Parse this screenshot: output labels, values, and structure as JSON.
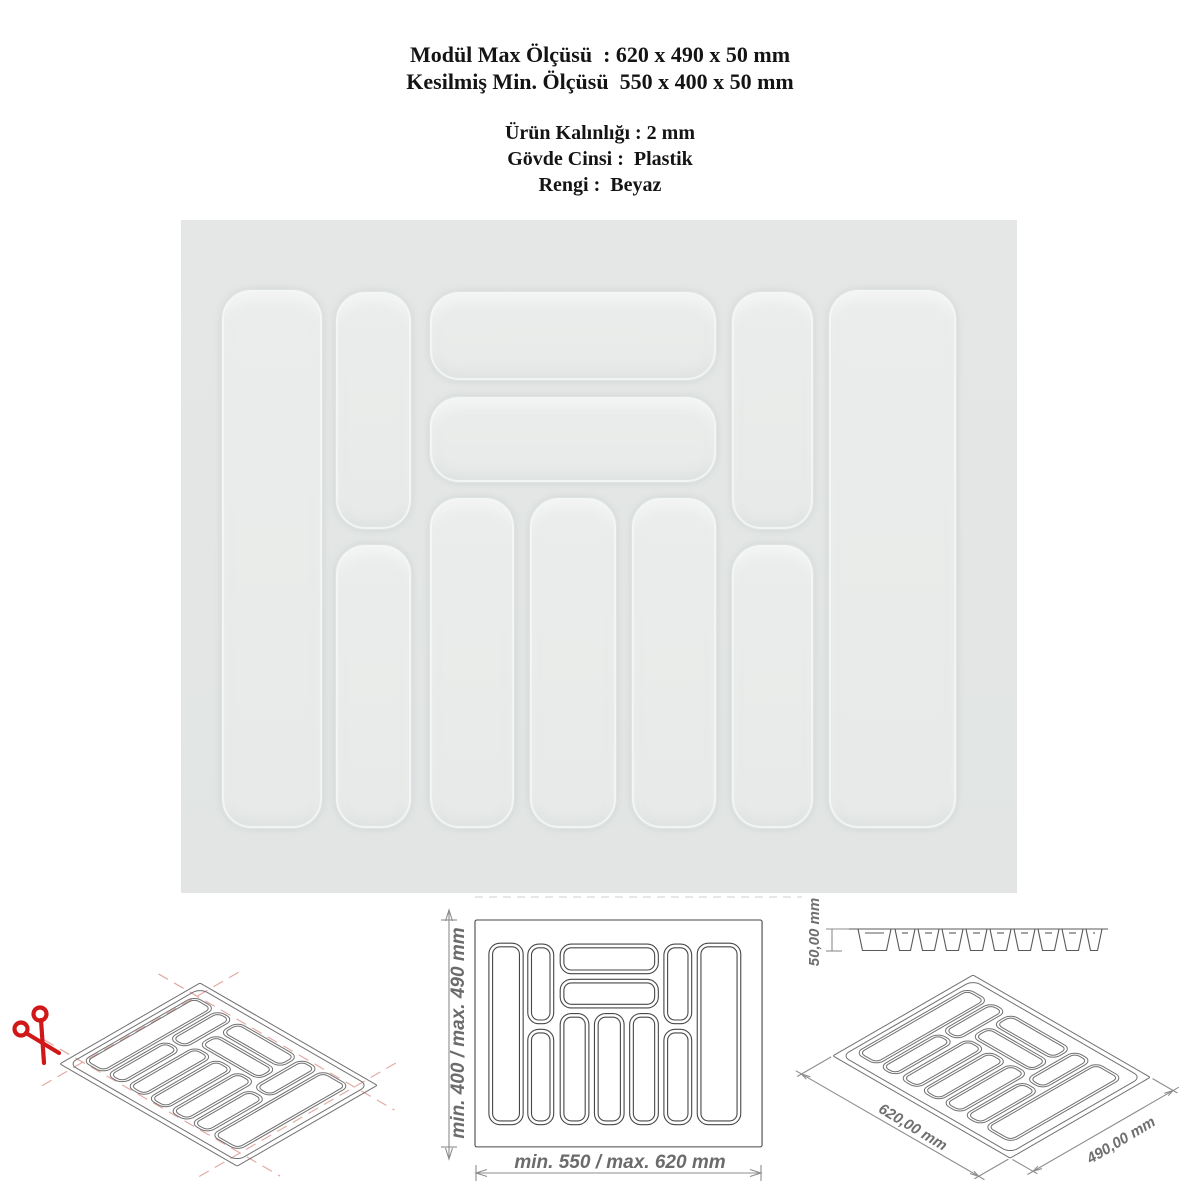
{
  "header": {
    "lines": [
      "Modül Max Ölçüsü  : 620 x 490 x 50 mm",
      "Kesilmiş Min. Ölçüsü  550 x 400 x 50 mm",
      "Ürün Kalınlığı : 2 mm",
      "Gövde Cinsi :  Plastik",
      "Rengi :  Beyaz"
    ]
  },
  "product": {
    "type": "plastic cutlery tray insert, white, top view photo",
    "compartment_count": 11
  },
  "dimensions": {
    "top_view": {
      "height_label": "min. 400 / max. 490 mm",
      "width_label": "min. 550 / max. 620 mm"
    },
    "profile": {
      "depth_label": "50,00 mm"
    },
    "isometric": {
      "width_label": "620,00 mm",
      "depth_label": "490,00 mm"
    }
  },
  "icons": {
    "scissors": "cut-here scissors mark"
  },
  "colors": {
    "photo_bg": "#e4e6e5",
    "compartment_fill": "#e9ebea",
    "drawing_line": "#707070",
    "dim_text": "#6b6b6b",
    "trim_line": "#e2aaa5",
    "scissors_red": "#d01818",
    "header_text": "#141414"
  }
}
